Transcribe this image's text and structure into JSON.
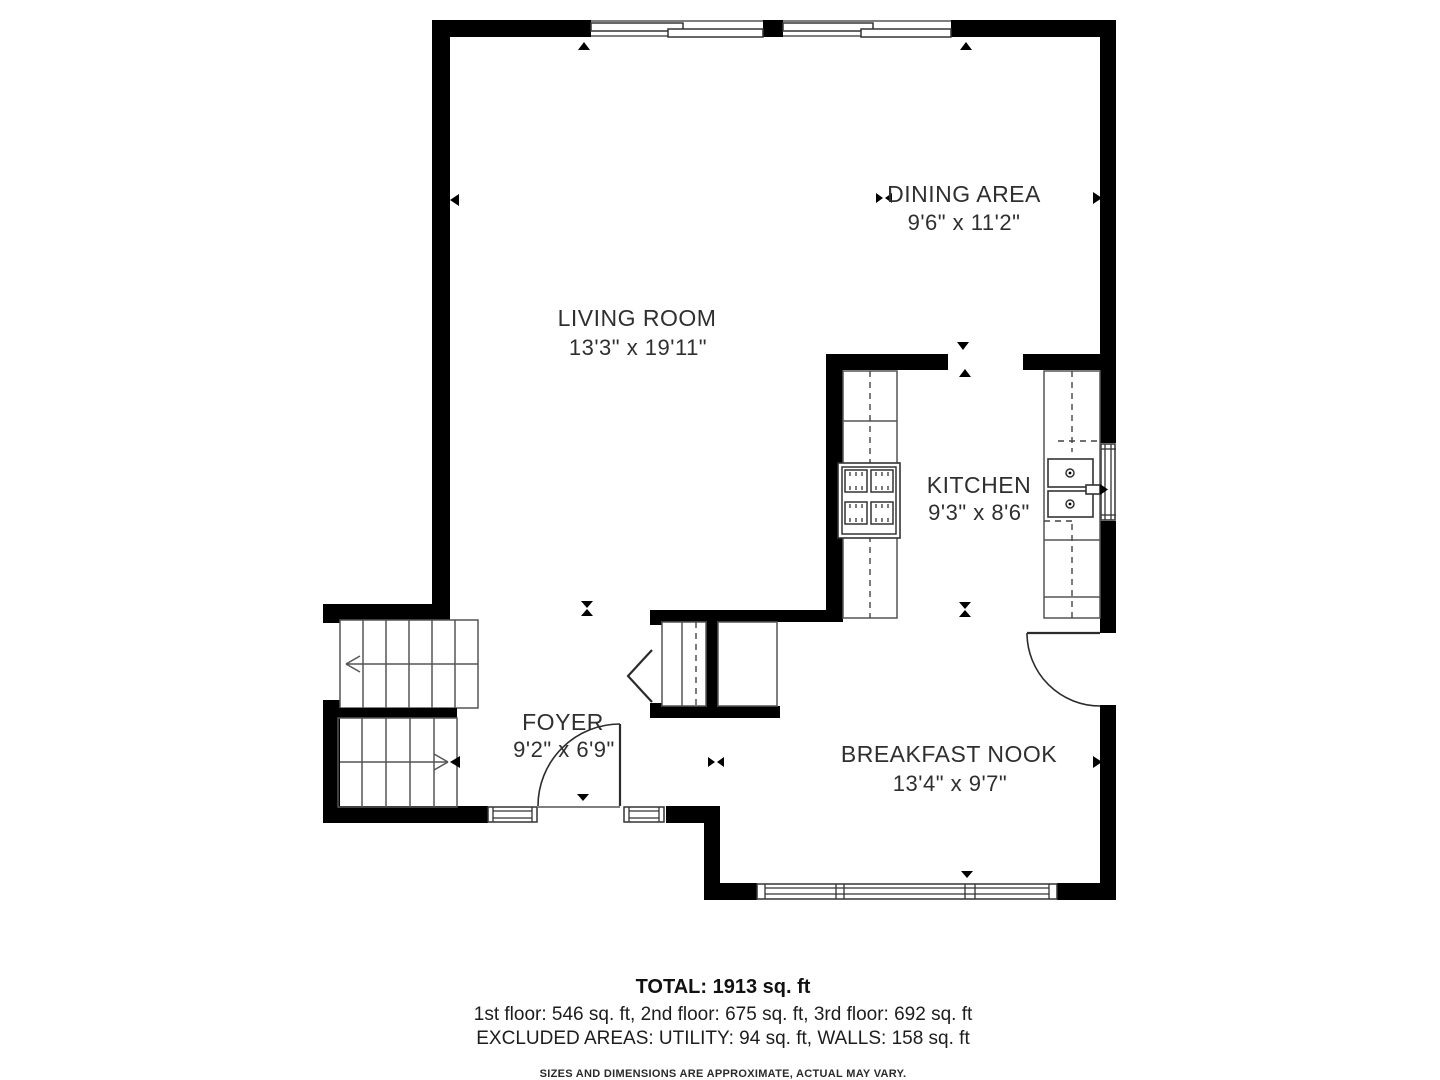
{
  "rooms": {
    "living": {
      "name": "LIVING ROOM",
      "dims": "13'3\" x 19'11\""
    },
    "dining": {
      "name": "DINING AREA",
      "dims": "9'6\" x 11'2\""
    },
    "kitchen": {
      "name": "KITCHEN",
      "dims": "9'3\" x 8'6\""
    },
    "foyer": {
      "name": "FOYER",
      "dims": "9'2\" x 6'9\""
    },
    "nook": {
      "name": "BREAKFAST NOOK",
      "dims": "13'4\" x 9'7\""
    }
  },
  "summary": {
    "total": "TOTAL: 1913 sq. ft",
    "floors": "1st floor: 546 sq. ft, 2nd floor: 675 sq. ft, 3rd floor: 692 sq. ft",
    "excluded": "EXCLUDED AREAS: UTILITY: 94 sq. ft, WALLS: 158 sq. ft",
    "disclaimer": "SIZES AND DIMENSIONS ARE APPROXIMATE, ACTUAL MAY VARY."
  },
  "colors": {
    "wall": "#000000",
    "background": "#ffffff",
    "text": "#2f2f2f"
  }
}
